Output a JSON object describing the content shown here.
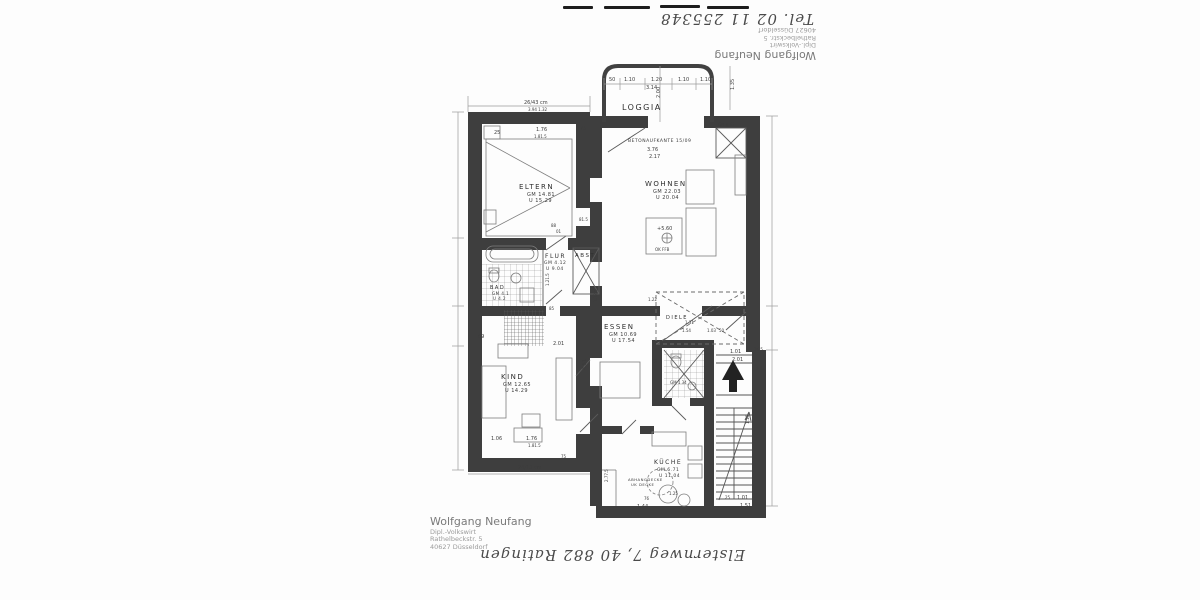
{
  "document": {
    "handwriting_top": "Tel. 02 11 255348",
    "handwriting_bottom": "Elsternweg 7, 40 882 Ratingen",
    "stamp": {
      "line1": "Wolfgang Neufang",
      "line2": "Dipl.-Volkswirt",
      "line3": "Rathelbeckstr. 5",
      "line4": "40627 Düsseldorf"
    }
  },
  "plan": {
    "rooms": {
      "loggia": {
        "name": "LOGGIA"
      },
      "eltern": {
        "name": "ELTERN",
        "gm": "GM 14.81",
        "u": "U 15.29"
      },
      "wohnen": {
        "name": "WOHNEN",
        "gm": "GM 22.03",
        "u": "U 20.04"
      },
      "flur": {
        "name": "FLUR",
        "gm": "GM 4.12",
        "u": "U 9.04"
      },
      "abst": {
        "name": "ABST"
      },
      "bad": {
        "name": "BAD",
        "gm": "GM 4.1",
        "u": "U 4.2"
      },
      "essen": {
        "name": "ESSEN",
        "gm": "GM 10.69",
        "u": "U 17.54"
      },
      "diele": {
        "name": "DIELE"
      },
      "kind": {
        "name": "KIND",
        "gm": "GM 12.65",
        "u": "U 14.29"
      },
      "wc": {
        "name": "WC",
        "gm": "GM 1.34"
      },
      "kueche": {
        "name": "KÜCHE",
        "gm": "GM 6.71",
        "u": "U 11.04"
      }
    },
    "notes": {
      "betonaufkante": "BETONAUFKANTE 15/09",
      "level_mark": "+5.60",
      "level_ref": "OK FFB",
      "ceiling1": "ABHANGDECKE",
      "ceiling2": "UK DECKE"
    },
    "dims": [
      {
        "t": "50",
        "x": 609,
        "y": 81
      },
      {
        "t": "1.10",
        "x": 624,
        "y": 81
      },
      {
        "t": "1.20",
        "x": 651,
        "y": 81
      },
      {
        "t": "1.10",
        "x": 678,
        "y": 81
      },
      {
        "t": "1.10",
        "x": 700,
        "y": 81
      },
      {
        "t": "3.14",
        "x": 646,
        "y": 89
      },
      {
        "t": "2.00",
        "x": 660,
        "y": 98,
        "r": -90
      },
      {
        "t": "1.35",
        "x": 734,
        "y": 90,
        "r": -90
      },
      {
        "t": "26/43 cm",
        "x": 524,
        "y": 104,
        "s": 5
      },
      {
        "t": "3.94  1.32",
        "x": 528,
        "y": 111,
        "s": 4
      },
      {
        "t": "25",
        "x": 494,
        "y": 134
      },
      {
        "t": "1.76",
        "x": 536,
        "y": 131
      },
      {
        "t": "75",
        "x": 580,
        "y": 130
      },
      {
        "t": "1.81.5",
        "x": 534,
        "y": 138,
        "s": 4
      },
      {
        "t": "GM 0.63",
        "x": 718,
        "y": 126,
        "s": 4
      },
      {
        "t": "3.76",
        "x": 647,
        "y": 151
      },
      {
        "t": "2.17",
        "x": 649,
        "y": 158
      },
      {
        "t": "88",
        "x": 551,
        "y": 227,
        "s": 4
      },
      {
        "t": "01",
        "x": 556,
        "y": 233,
        "s": 4
      },
      {
        "t": "81.5",
        "x": 579,
        "y": 221,
        "s": 4
      },
      {
        "t": "+5.60",
        "x": 657,
        "y": 230
      },
      {
        "t": "OK FFB",
        "x": 655,
        "y": 251,
        "s": 4
      },
      {
        "t": "1.21.5",
        "x": 549,
        "y": 286,
        "r": -90,
        "s": 4
      },
      {
        "t": "1.12.5",
        "x": 597,
        "y": 302,
        "r": -90,
        "s": 4
      },
      {
        "t": "85",
        "x": 549,
        "y": 310,
        "s": 4
      },
      {
        "t": "2.01",
        "x": 553,
        "y": 345
      },
      {
        "t": "69",
        "x": 478,
        "y": 338
      },
      {
        "t": "1.22",
        "x": 648,
        "y": 301,
        "s": 4
      },
      {
        "t": "1.31",
        "x": 685,
        "y": 324,
        "s": 4
      },
      {
        "t": "1.54",
        "x": 682,
        "y": 332,
        "s": 4
      },
      {
        "t": "1.03",
        "x": 707,
        "y": 332,
        "s": 4
      },
      {
        "t": "50",
        "x": 719,
        "y": 332,
        "s": 4
      },
      {
        "t": "1.01",
        "x": 730,
        "y": 353
      },
      {
        "t": "2.01",
        "x": 732,
        "y": 361
      },
      {
        "t": "36.5",
        "x": 754,
        "y": 351,
        "s": 4
      },
      {
        "t": "5.82",
        "x": 756,
        "y": 370,
        "s": 4
      },
      {
        "t": "51",
        "x": 657,
        "y": 363,
        "r": -90,
        "s": 4
      },
      {
        "t": "4.51",
        "x": 586,
        "y": 370,
        "r": -90
      },
      {
        "t": "1.16",
        "x": 749,
        "y": 424,
        "r": -90,
        "s": 4
      },
      {
        "t": "2.77.5",
        "x": 608,
        "y": 482,
        "r": -90,
        "s": 4
      },
      {
        "t": "1.06",
        "x": 491,
        "y": 440
      },
      {
        "t": "1.76",
        "x": 526,
        "y": 440
      },
      {
        "t": "1.81.5",
        "x": 528,
        "y": 447,
        "s": 4
      },
      {
        "t": "75",
        "x": 561,
        "y": 458,
        "s": 4
      },
      {
        "t": "24/13 cm",
        "x": 518,
        "y": 469,
        "s": 5
      },
      {
        "t": "76",
        "x": 644,
        "y": 500,
        "s": 4
      },
      {
        "t": "1.44",
        "x": 637,
        "y": 508
      },
      {
        "t": "1.25",
        "x": 669,
        "y": 495,
        "s": 4
      },
      {
        "t": "25",
        "x": 725,
        "y": 499,
        "s": 4
      },
      {
        "t": "1.01",
        "x": 737,
        "y": 499
      },
      {
        "t": "1.51",
        "x": 740,
        "y": 507
      },
      {
        "t": "GM 1.34",
        "x": 670,
        "y": 384,
        "s": 4
      }
    ]
  },
  "colors": {
    "ink": "#3e3e3e",
    "paper": "#fdfdfd",
    "stamp_gray": "#8d8d8d"
  }
}
